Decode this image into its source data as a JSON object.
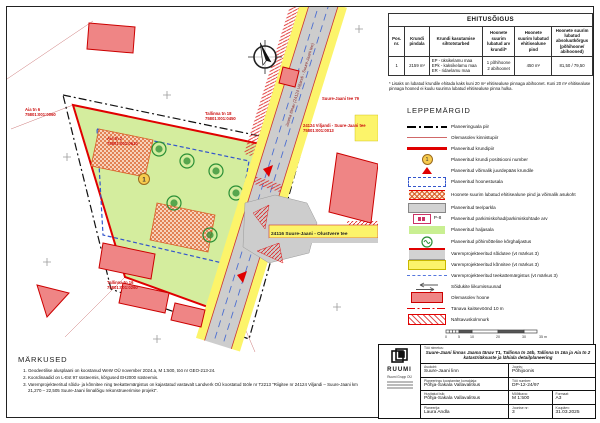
{
  "ehitusoigus": {
    "title": "EHITUSÕIGUS",
    "headers": [
      "Pos. nr.",
      "Krundi pindala",
      "Krundi kasutamise sihtotstarbed",
      "Hoonete suurim lubatud arv krundil*",
      "Hoonete suurim lubatud ehitisealune pind",
      "Hoonete suurim lubatud absoluutkõrgus (põhihoone/ abihooned)"
    ],
    "rows": [
      [
        "1",
        "2159 m²",
        "EP - üksikelamu maa\nEPk - kaksikelamu maa\nER - ridaelamu maa",
        "1 põhihoone\n2 abihoonet",
        "450 m²",
        "81,50 / 79,50"
      ]
    ],
    "footnote": "* Lisaks on lubatud krundile ehitada kaks kuni 20 m² ehitisealuse pinnaga abihoonet. Kuni 20 m² ehitisealuse pinnaga hooned ei kuulu suurima lubatud ehitisealuse pinna hulka."
  },
  "legend": {
    "title": "LEPPEMÄRGID",
    "pos_sample": "1",
    "parking_sample": "P-8",
    "items": [
      {
        "label": "Planeeringuala piir"
      },
      {
        "label": "Olemasolev kinnistupiir"
      },
      {
        "label": "Planeeritud krundipiir"
      },
      {
        "label": "Planeeritud krundi positsiooni number"
      },
      {
        "label": "Planeeritud võimalik juurdepääs krundile"
      },
      {
        "label": "Planeeritud hoonestusala"
      },
      {
        "label": "Hoonete suurim lubatud ehitisealune pind ja võimalik asukoht"
      },
      {
        "label": "Planeeritud tee/parkla"
      },
      {
        "label": "Planeeritud parkimiskohad/parkimiskohtade arv"
      },
      {
        "label": "Planeeritud haljasala"
      },
      {
        "label": "Planeeritud põhimõtteline kõrghaljastus"
      },
      {
        "label": "Varemprojekteeritud sõidutee (vt märkus 3)"
      },
      {
        "label": "Varemprojekteeritud kõnnitee (vt märkus 3)"
      },
      {
        "label": "Varemprojekteeritud teekattemärgistus (vt märkus 3)"
      },
      {
        "label": "Sõidukite liikumissuunad"
      },
      {
        "label": "Olemasolev hoone"
      },
      {
        "label": "Tänava kaitsevöönd 10 m"
      },
      {
        "label": "Nähtavuskolmnurk"
      }
    ]
  },
  "notes": {
    "title": "MÄRKUSED",
    "items": [
      "Geodeetilise alusplaani on koostanud WeW OÜ november 2024.a, M 1:500, töö nr GEO-213-24.",
      "Koordinaadid on L-Est 97 süsteemis, kõrgused EH2000 süsteemis.",
      "Varemprojekteeritud sõidu- ja kõnnitee ning teekattemärgistus on kajastatud vastavalt Landverk OÜ koostatud tööle nr T2213 \"Riigitee nr 24124 Viljandi – Suure-Jaani km 21,270 – 22,505 Suure-Jaani linnalõigu rekonstrueerimise projekt\"."
    ]
  },
  "titleblock": {
    "company": "RUUMI",
    "company_sub": "Ruumi Grupp OÜ",
    "project_label": "Töö nimetus:",
    "project_title": "Suure-Jaani linnas Jaama tänav T1, Tallinna tn 16b, Tallinna tn 16a ja Aia tn 2 katastriüksuste ja lähiala detailplaneering",
    "asukoht_label": "Asukoht:",
    "asukoht": "Suure-Jaani linn",
    "korraldaja_label": "Planeeringu koostamise korraldaja:",
    "korraldaja": "Põhja-Sakala Vallavalitsus",
    "huvitatud_label": "Huvitatud isik:",
    "huvitatud": "Põhja-Sakala Vallavalitsus",
    "planeerija_label": "Planeerija:",
    "planeerija": "Laura Andla",
    "joonis_label": "Joonis:",
    "joonis": "Põhijoonis",
    "too_nr_label": "Töö number:",
    "too_nr": "DP-12-24/97",
    "mootkava_label": "Mõõtkava:",
    "mootkava": "M 1:500",
    "formaat_label": "Formaat:",
    "formaat": "A3",
    "joonise_nr_label": "Joonise nr:",
    "joonise_nr": "3",
    "kuupaev_label": "Kuupäev:",
    "kuupaev": "31.03.2025"
  },
  "map": {
    "plot_number": "1",
    "road_main_label": "Jaama tänav (24124 Viljandi - Suure-Jaani tee)",
    "road_branch_label": "24116 Suure-Jaani - Olustvere tee",
    "labels": [
      {
        "text": "Aia tn 6",
        "sub": "75801:001:0060"
      },
      {
        "text": "Aia tn 2",
        "sub": "75801:001:0610"
      },
      {
        "text": "Tallinna tn 18",
        "sub": "75801:001:0450"
      },
      {
        "text": "Tallinna tn 16",
        "sub": "75801:001:0260"
      },
      {
        "text": "24124 Viljandi - Suure-Jaani tee",
        "sub": "75801:001:0013"
      },
      {
        "text": "Suure-Jaani tee 79",
        "sub": ""
      }
    ]
  },
  "scalebar": {
    "ticks": [
      "0",
      "5",
      "10",
      "20",
      "30",
      "35 m"
    ]
  },
  "colors": {
    "plot_green": "#d4ed9e",
    "road_yellow": "#fcf46a",
    "road_gray": "#cdcdcd",
    "building_red": "#ef8585",
    "boundary_red": "#e00000",
    "hatch_orange": "#d95f28",
    "dash_blue": "#3355cc"
  }
}
